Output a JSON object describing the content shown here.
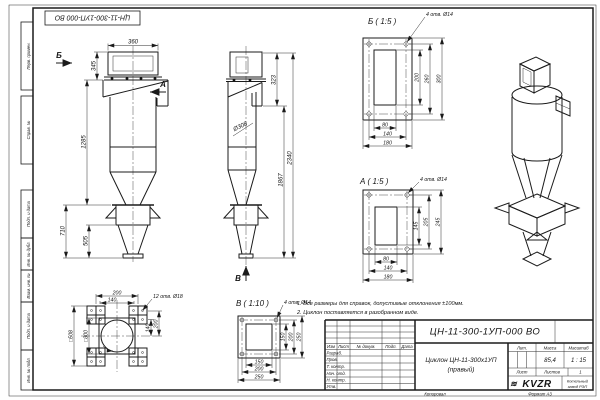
{
  "sheet": {
    "stamp_top": "ЦН-11-300-1УП-000 ВО",
    "margin_labels": [
      "Перв. примен.",
      "Справ. №",
      "Подп. и дата",
      "Инв. № дубл.",
      "Взам. инв. №",
      "Подп. и дата",
      "Инв. № подл."
    ],
    "copied": "Копировал",
    "format": "Формат А3"
  },
  "views": {
    "front": {
      "arrow_left": "Б",
      "arrow_right": "А",
      "dim_width": "360",
      "dim_inlet_h": "345",
      "dim_body_h": "1285",
      "dim_support_h": "710",
      "dim_cone_h": "505"
    },
    "side": {
      "arrow_bottom": "В",
      "dim_dia": "Ø308",
      "dim_top": "323",
      "dim_inner_h": "1867",
      "dim_total_h": "2340"
    },
    "bottom": {
      "holes": "12 отв. Ø18",
      "dim_top_outer": "200",
      "dim_top_inner": "140",
      "dim_right_inner": "140",
      "dim_right_outer": "200",
      "dim_square_outer": "□508",
      "dim_square_inner": "□300"
    },
    "detail_b": {
      "title": "Б ( 1:5 )",
      "holes": "4 отв. Ø14",
      "v": [
        "200",
        "260",
        "300"
      ],
      "h": [
        "80",
        "140",
        "180"
      ]
    },
    "detail_a": {
      "title": "А ( 1:5 )",
      "holes": "4 отв. Ø14",
      "v": [
        "145",
        "205",
        "245"
      ],
      "h": [
        "80",
        "140",
        "180"
      ]
    },
    "detail_v": {
      "title": "В ( 1:10 )",
      "holes": "4 отв. Ø14",
      "v": [
        "150",
        "200",
        "250"
      ],
      "h": [
        "150",
        "200",
        "250"
      ]
    }
  },
  "notes": [
    "1. Все размеры для справок, допустимые отклонения ±100мм.",
    "2. Циклон поставляется в разобранном виде."
  ],
  "title_block": {
    "doc_number": "ЦН-11-300-1УП-000 ВО",
    "name_line1": "Циклон ЦН-11-300х1УП",
    "name_line2": "(правый)",
    "col_headers": [
      "Изм",
      "Лист",
      "№ докум.",
      "Подп.",
      "Дата"
    ],
    "row_labels": [
      "Разраб.",
      "Пров.",
      "Т. контр.",
      "Нач. отд.",
      "Н. контр.",
      "Утв."
    ],
    "lit": "Лит.",
    "mass": "Масса",
    "scale": "Масштаб",
    "mass_value": "85,4",
    "scale_value": "1 : 15",
    "sheet": "Лист",
    "sheets": "Листов",
    "sheets_value": "1",
    "logo": "KVZR",
    "company_line1": "Котельный",
    "company_line2": "завод РЭП"
  }
}
